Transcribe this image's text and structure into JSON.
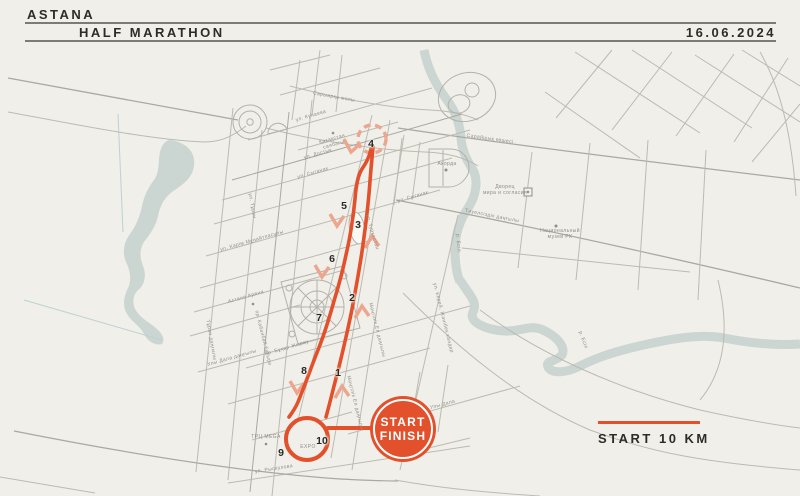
{
  "header": {
    "brand_line1": "ASTANA",
    "brand_line2": "HALF MARATHON",
    "date": "16.06.2024"
  },
  "colors": {
    "background": "#F0EFE9",
    "route_accent": "#E2512B",
    "route_accent_light": "#EDA58E",
    "water": "#CBD5D2",
    "street": "#BBBBB2",
    "label_gray": "#8F8F88",
    "text_dark": "#2E2C26"
  },
  "map": {
    "badge": {
      "line1": "START",
      "line2": "FINISH"
    },
    "legend": {
      "label": "START 10 KM"
    },
    "route_markers": [
      {
        "n": "1",
        "x": 338,
        "y": 373
      },
      {
        "n": "2",
        "x": 352,
        "y": 298
      },
      {
        "n": "3",
        "x": 358,
        "y": 225
      },
      {
        "n": "4",
        "x": 371,
        "y": 144
      },
      {
        "n": "5",
        "x": 344,
        "y": 206
      },
      {
        "n": "6",
        "x": 332,
        "y": 259
      },
      {
        "n": "7",
        "x": 319,
        "y": 318
      },
      {
        "n": "8",
        "x": 304,
        "y": 371
      },
      {
        "n": "9",
        "x": 281,
        "y": 453
      },
      {
        "n": "10",
        "x": 322,
        "y": 441
      }
    ],
    "street_labels": [
      {
        "t": "ул. Кунаева",
        "x": 311,
        "y": 116,
        "r": -16
      },
      {
        "t": "Қазақстан\nсаябағы",
        "x": 333,
        "y": 142,
        "r": -16
      },
      {
        "t": "ул. Достык",
        "x": 318,
        "y": 154,
        "r": -16
      },
      {
        "t": "ул. Сыганак",
        "x": 313,
        "y": 173,
        "r": -16
      },
      {
        "t": "ул. Сыганак",
        "x": 413,
        "y": 197,
        "r": -16
      },
      {
        "t": "ул. Кәрім Мұңайтпасұлы",
        "x": 252,
        "y": 241,
        "r": -16
      },
      {
        "t": "ул. Туркестан",
        "x": 372,
        "y": 232,
        "r": 74
      },
      {
        "t": "ул. Тұран",
        "x": 252,
        "y": 206,
        "r": 80
      },
      {
        "t": "Мәңгілік Ел даңғылы",
        "x": 377,
        "y": 330,
        "r": 76
      },
      {
        "t": "Мәңгілік Ел даңғылы",
        "x": 355,
        "y": 403,
        "r": 76
      },
      {
        "t": "ул. Керей, Жәнібек хандар",
        "x": 443,
        "y": 318,
        "r": 76
      },
      {
        "t": "Астана Арена",
        "x": 246,
        "y": 297,
        "r": -16
      },
      {
        "t": "Тұран даңғылы",
        "x": 211,
        "y": 340,
        "r": 80
      },
      {
        "t": "пр. Кабанбай батыра",
        "x": 263,
        "y": 338,
        "r": 76
      },
      {
        "t": "Улы Дала даңғылы",
        "x": 232,
        "y": 358,
        "r": -16
      },
      {
        "t": "пр. Бұқар Жырау",
        "x": 287,
        "y": 348,
        "r": -16
      },
      {
        "t": "пр. Улы Дала",
        "x": 438,
        "y": 406,
        "r": -15
      },
      {
        "t": "ТРЦ MEGA",
        "x": 266,
        "y": 437,
        "r": 0
      },
      {
        "t": "EXPO",
        "x": 308,
        "y": 447,
        "r": 0
      },
      {
        "t": "ул. Рыскулова",
        "x": 274,
        "y": 469,
        "r": -9
      },
      {
        "t": "Акорда",
        "x": 447,
        "y": 164,
        "r": 0
      },
      {
        "t": "Дворец\nмира и согласия",
        "x": 505,
        "y": 190,
        "r": 0
      },
      {
        "t": "Национальный\nмузей РК",
        "x": 560,
        "y": 234,
        "r": 0
      },
      {
        "t": "Сарыарқа жолы",
        "x": 334,
        "y": 97,
        "r": 10
      },
      {
        "t": "Сарайшық көшесі",
        "x": 490,
        "y": 139,
        "r": 8
      },
      {
        "t": "Тәуелсіздік даңғылы",
        "x": 492,
        "y": 216,
        "r": 11
      },
      {
        "t": "р. Есіл",
        "x": 583,
        "y": 340,
        "r": 70
      },
      {
        "t": "р. Есіл",
        "x": 458,
        "y": 243,
        "r": 85
      }
    ]
  }
}
